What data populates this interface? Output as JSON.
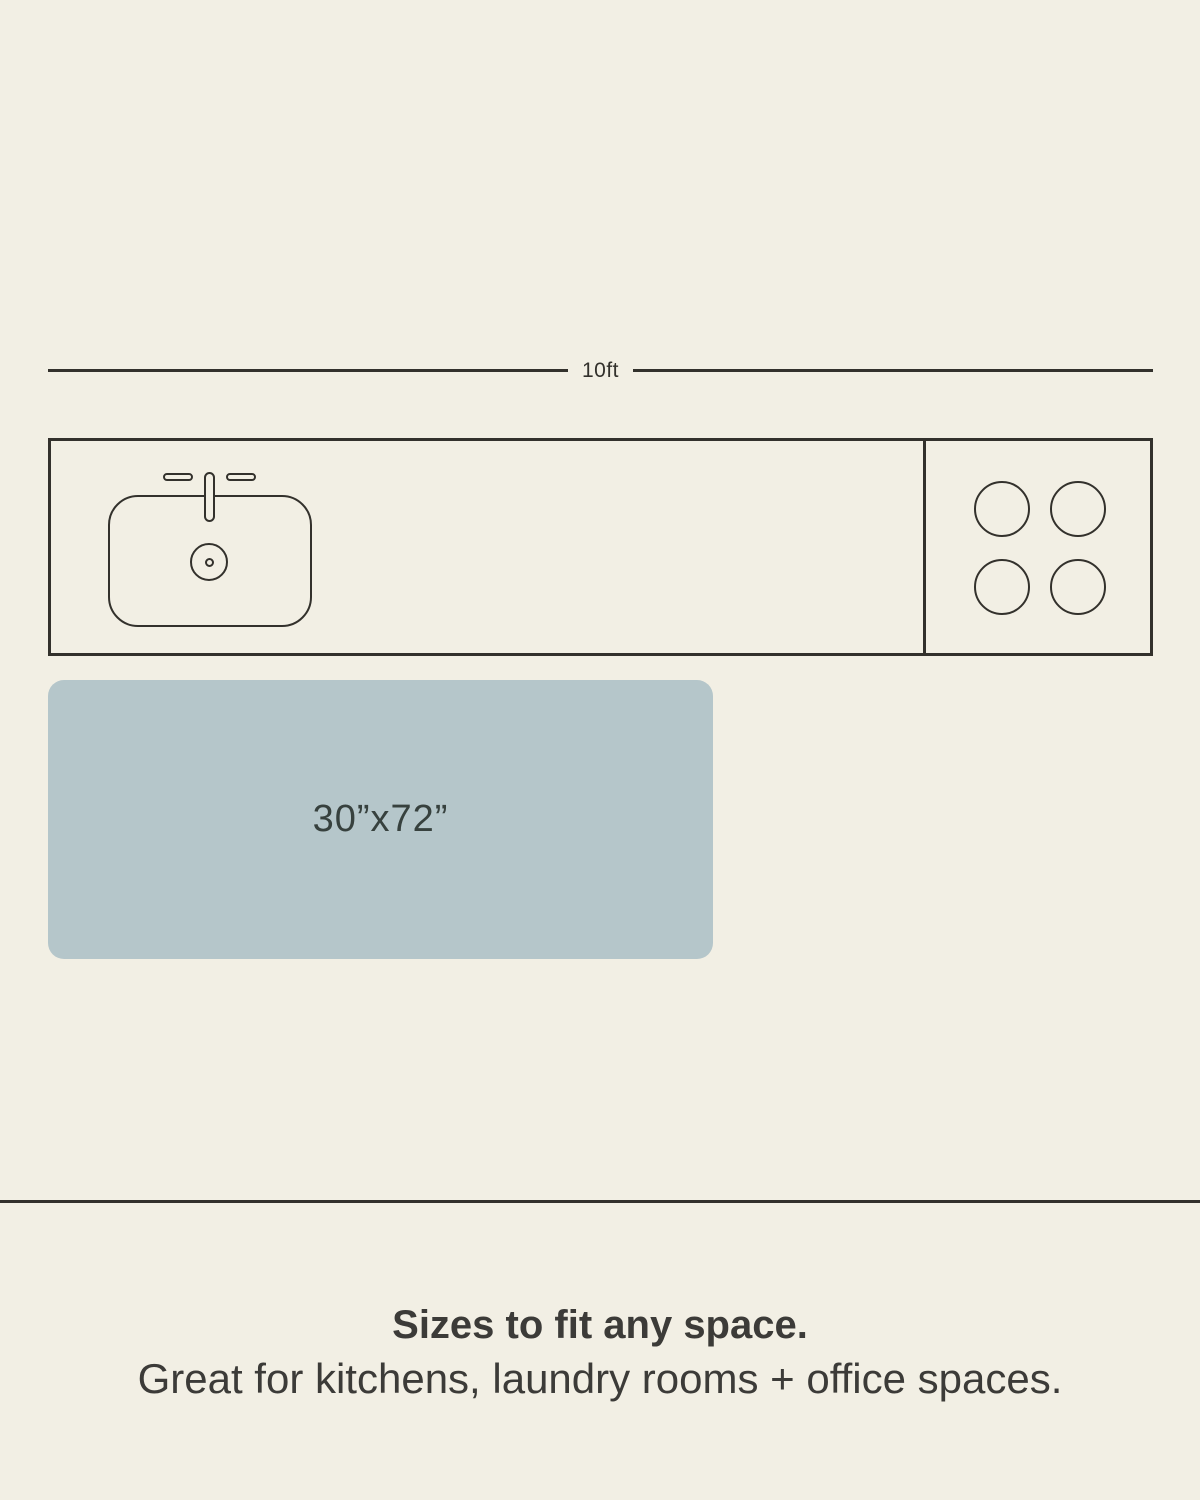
{
  "colors": {
    "background": "#F2EFE4",
    "line": "#33312C",
    "text": "#3C3B38",
    "mat": "#B5C6CA",
    "mat_text": "#37413E"
  },
  "dimension": {
    "label": "10ft"
  },
  "icons": {
    "sink": "sink-top-view-icon",
    "stove": "four-burner-cooktop-icon"
  },
  "mat": {
    "size_label": "30”x72”"
  },
  "footer": {
    "heading": "Sizes to fit any space.",
    "subheading": "Great for kitchens, laundry rooms + office spaces."
  }
}
